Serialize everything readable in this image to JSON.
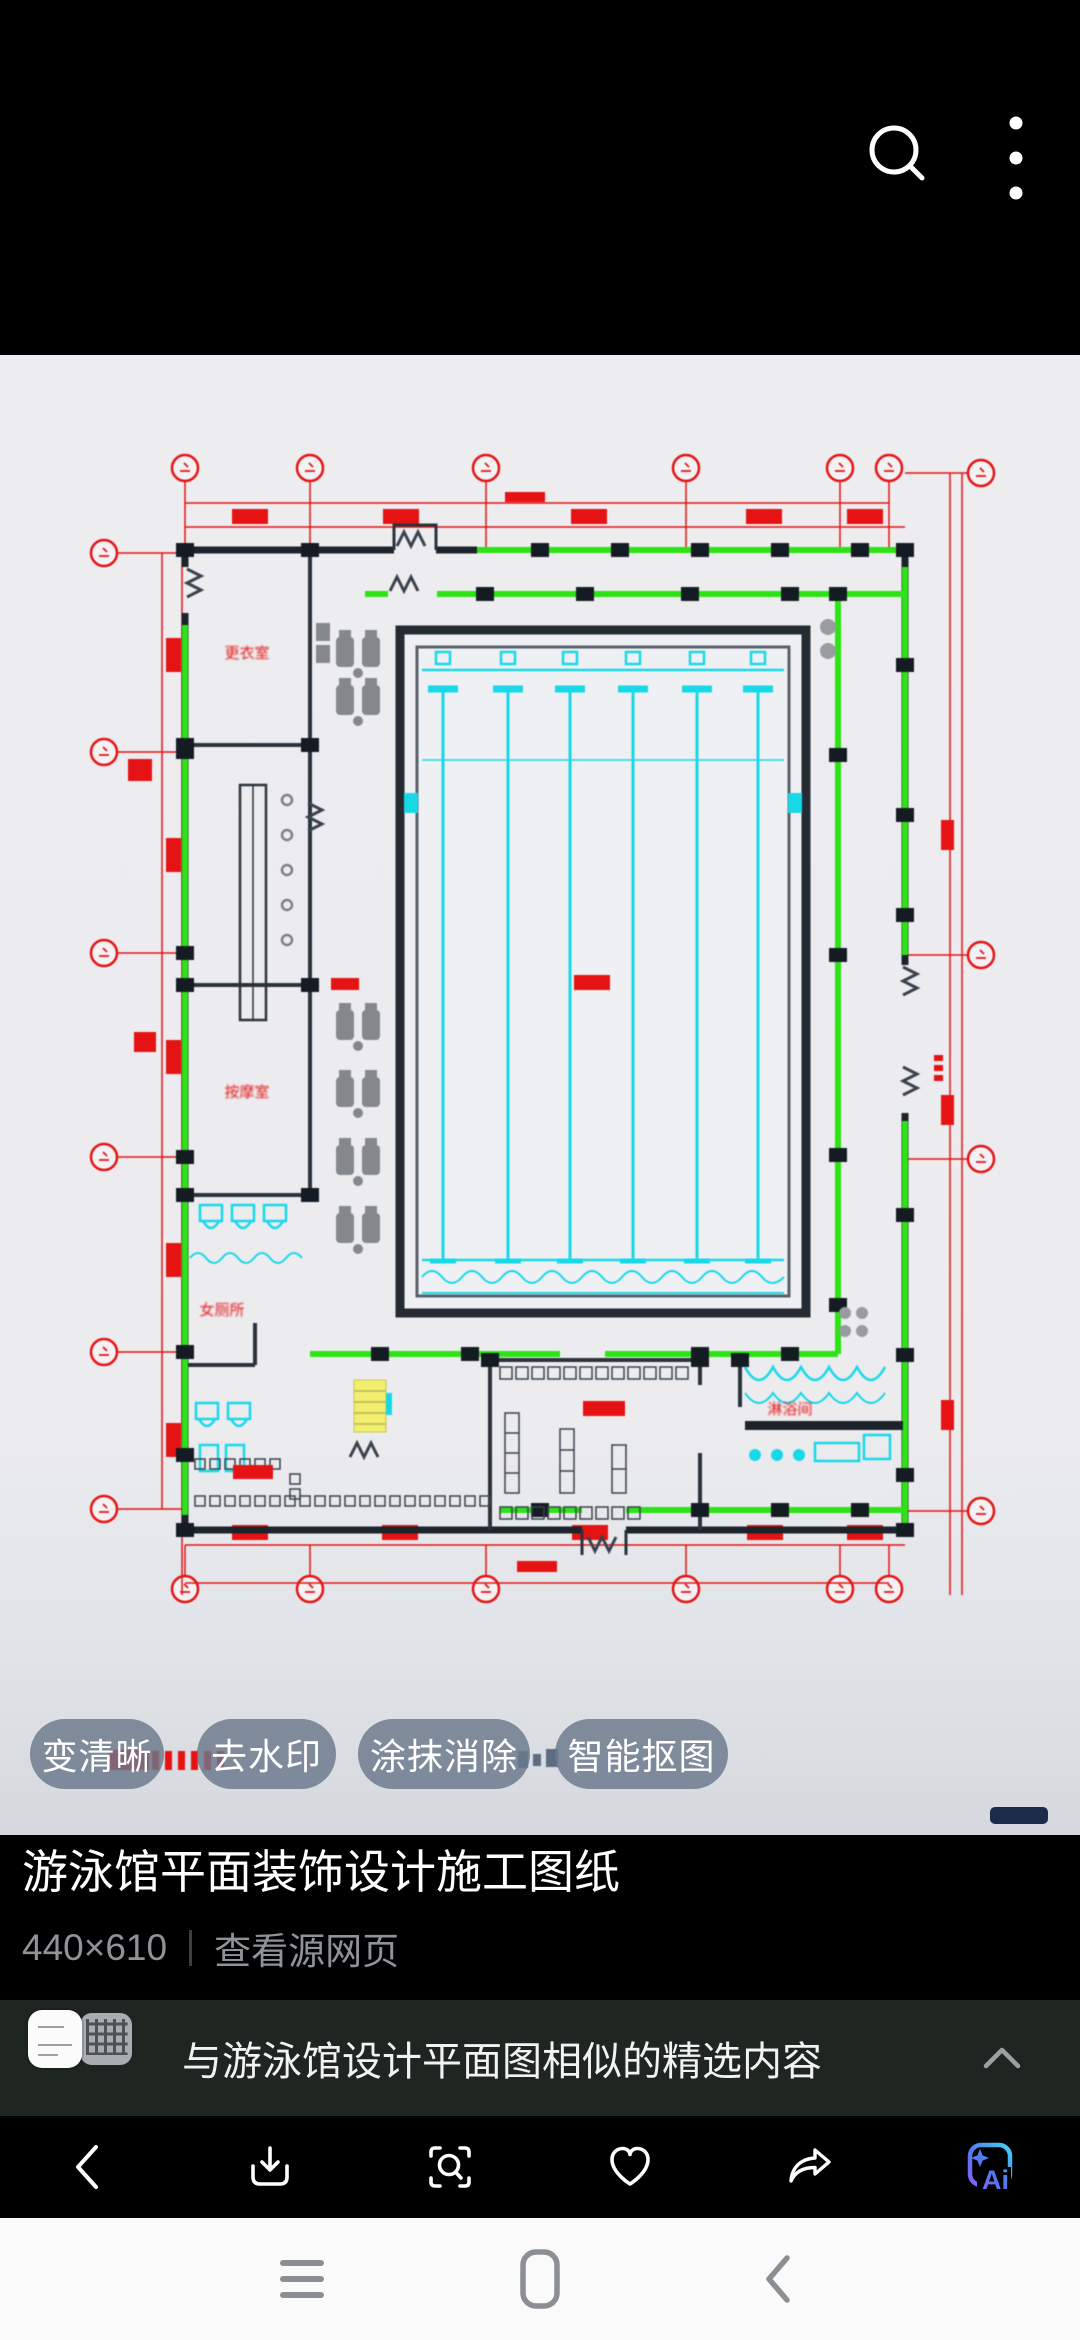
{
  "top_bar": {
    "icons": [
      "search-icon",
      "more-options-icon"
    ]
  },
  "chips": [
    {
      "label": "变清晰"
    },
    {
      "label": "去水印"
    },
    {
      "label": "涂抹消除"
    },
    {
      "label": "智能抠图"
    }
  ],
  "caption": {
    "title": "游泳馆平面装饰设计施工图纸",
    "resolution": "440×610",
    "source_link": "查看源网页"
  },
  "related": {
    "title": "与游泳馆设计平面图相似的精选内容",
    "collapse_icon": "chevron-up-icon",
    "thumbnails": [
      "white-plan-thumbnail",
      "gray-plan-thumbnail"
    ]
  },
  "toolbar": {
    "icons": [
      "back-icon",
      "download-icon",
      "image-search-icon",
      "favorite-icon",
      "share-icon",
      "ai-icon"
    ],
    "ai_label": "Ai"
  },
  "nav": {
    "icons": [
      "recents-menu-icon",
      "home-icon",
      "back-icon"
    ]
  },
  "plan": {
    "description": "CAD construction drawing of a swimming pool hall, plan view",
    "labels": [
      {
        "text": "更衣室"
      },
      {
        "text": "按摩室"
      },
      {
        "text": "女厕所"
      },
      {
        "text": "淋浴间"
      }
    ],
    "colors": {
      "dimension_red": "#e51313",
      "glazing_green": "#2de315",
      "pool_cyan": "#18d8e8",
      "wall_dark": "#1c232a",
      "stair_yellow": "#f1ef6d",
      "furniture_gray": "#84888d",
      "paper": "#ededf0"
    },
    "pool_lanes": 6
  },
  "accent": {
    "ai_gradient": [
      "#45d7f2",
      "#4f7bf0",
      "#8b5cf6"
    ],
    "indicator_navy": "#1c2b49"
  }
}
